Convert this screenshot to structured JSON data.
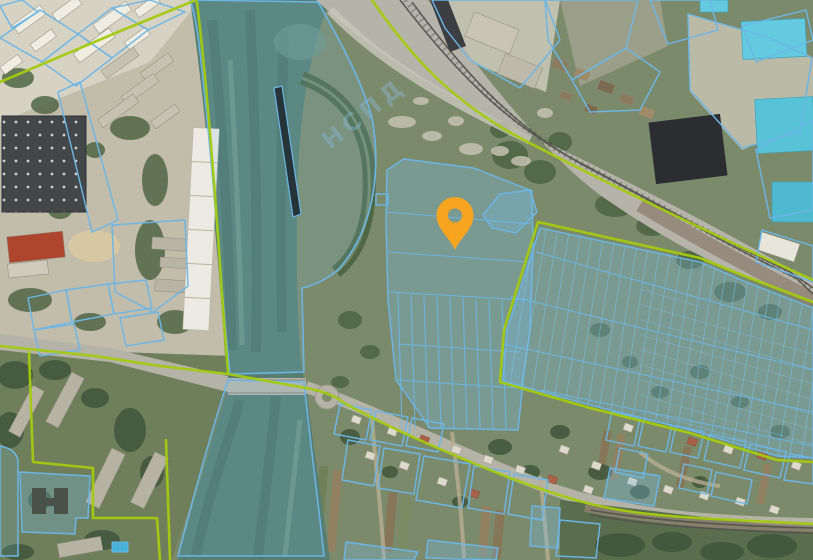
{
  "map": {
    "title": "cadastral-satellite-map",
    "marker": {
      "name": "selected-location",
      "x": 455,
      "y": 250,
      "transform": "translate(455,250)"
    },
    "watermark": {
      "text": "НСПД"
    },
    "features": {
      "river": "river-channel",
      "bridge": "road-bridge",
      "roundabout": "roundabout",
      "railway": "railway-corridor",
      "allotments": "allotment-parcel-grid",
      "village": "village-parcels",
      "industrial": "industrial-zone",
      "school": "school-parcel",
      "apartments": "residential-blocks"
    }
  },
  "colors": {
    "parcel_line": "#6cb6e6",
    "parcel_fill": "rgba(118,190,232,0.30)",
    "parcel_fill_light": "rgba(118,190,232,0.16)",
    "boundary_line": "#a4ca10",
    "marker": "#F7A420",
    "water": "#587e72",
    "field": "#7c8a6c",
    "road": "#b5b3a7",
    "industrial_ground": "#c2bcab",
    "tree": "#49603f",
    "watermark": "rgba(140,190,230,0.38)"
  }
}
